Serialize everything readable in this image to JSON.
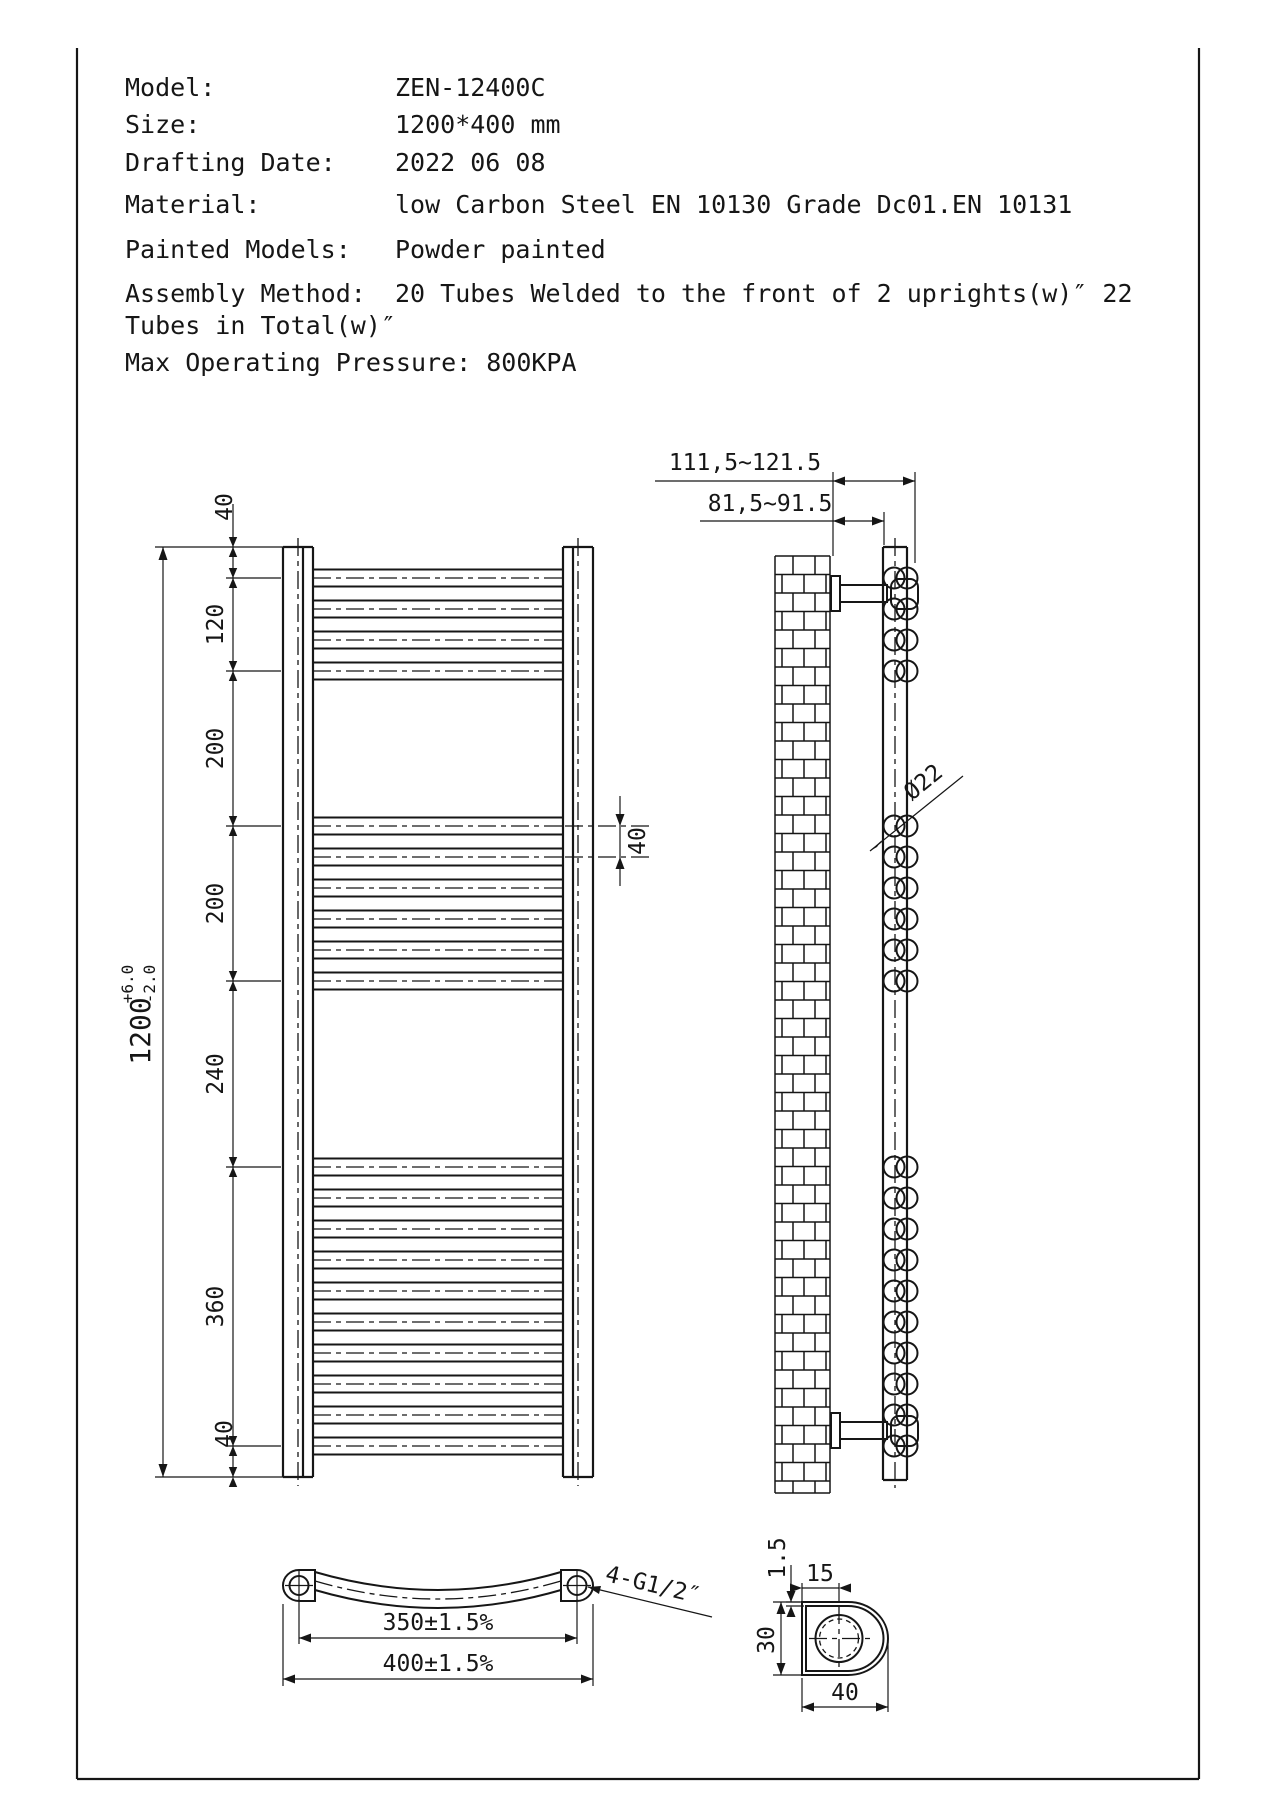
{
  "header": {
    "rows": [
      {
        "label": "Model:",
        "value": "ZEN-12400C"
      },
      {
        "label": "Size:",
        "value": "1200*400 mm"
      },
      {
        "label": "Drafting Date:",
        "value": "2022 06 08"
      },
      {
        "label": "Material:",
        "value": "low Carbon Steel  EN 10130 Grade Dc01.EN 10131"
      },
      {
        "label": "Painted Models:",
        "value": "Powder painted"
      },
      {
        "label": "Assembly Method:",
        "value": "20 Tubes Welded to the front of 2 uprights(w)″  22"
      }
    ],
    "assembly_continuation": "Tubes in Total(w)″",
    "max_pressure_line": "Max Operating Pressure: 800KPA"
  },
  "front_view": {
    "segments_mm": [
      40,
      120,
      200,
      200,
      240,
      360,
      40
    ],
    "dim_chain": [
      "40",
      "120",
      "200",
      "200",
      "240",
      "360",
      "40"
    ],
    "tube_groups": [
      4,
      6,
      10
    ],
    "tube_count": 20,
    "overall": {
      "value": "1200",
      "tol_plus": "+6.0",
      "tol_minus": "-2.0"
    },
    "pitch_label": "40"
  },
  "side_view": {
    "dim_wall_to_front": "111,5~121.5",
    "dim_wall_to_upright": "81,5~91.5",
    "tube_diameter": "Ø22"
  },
  "plan_view": {
    "dim_centers": "350±1.5%",
    "dim_overall": "400±1.5%",
    "connection_label": "4-G1/2″"
  },
  "detail_view": {
    "wall_thickness": "1.5",
    "hole_offset": "15",
    "profile_height": "30",
    "profile_width": "40"
  }
}
